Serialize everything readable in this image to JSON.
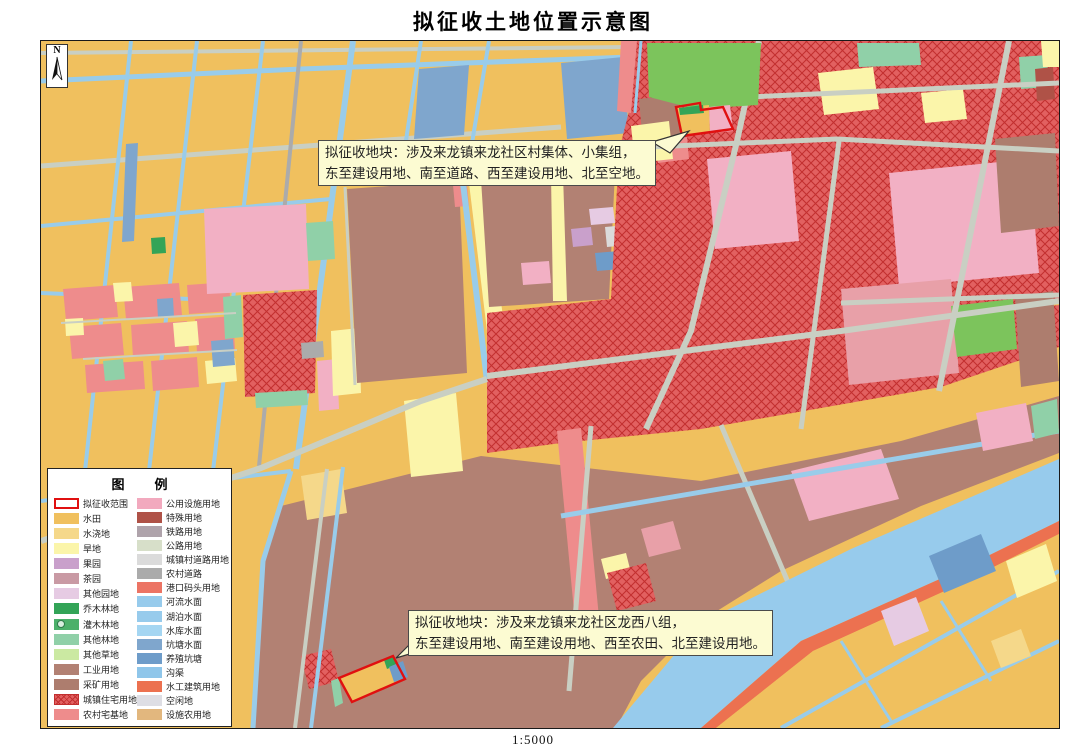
{
  "title": "拟征收土地位置示意图",
  "scale": "1:5000",
  "north_label": "N",
  "legend": {
    "title_left": "图",
    "title_right": "例",
    "columns": [
      {
        "items": [
          {
            "label": "拟征收范围",
            "color": "#FFFFFF",
            "type": "outline"
          },
          {
            "label": "水田",
            "color": "#F0C05E"
          },
          {
            "label": "水浇地",
            "color": "#F5D88A"
          },
          {
            "label": "旱地",
            "color": "#FBF5AA"
          },
          {
            "label": "果园",
            "color": "#C9A0CB"
          },
          {
            "label": "茶园",
            "color": "#C99AA4"
          },
          {
            "label": "其他园地",
            "color": "#E6CBE3"
          },
          {
            "label": "乔木林地",
            "color": "#33A457"
          },
          {
            "label": "灌木林地",
            "color": "#4CB06A",
            "type": "circle"
          },
          {
            "label": "其他林地",
            "color": "#90D0A8"
          },
          {
            "label": "其他草地",
            "color": "#CBE9A2"
          },
          {
            "label": "工业用地",
            "color": "#B28173"
          },
          {
            "label": "采矿用地",
            "color": "#AD7D6E"
          },
          {
            "label": "城镇住宅用地",
            "color": "#E26060",
            "type": "crosshatch"
          },
          {
            "label": "农村宅基地",
            "color": "#EE8C8C"
          }
        ]
      },
      {
        "items": [
          {
            "label": "公用设施用地",
            "color": "#F2A9BE"
          },
          {
            "label": "特殊用地",
            "color": "#AF5247"
          },
          {
            "label": "铁路用地",
            "color": "#AFA3AB"
          },
          {
            "label": "公路用地",
            "color": "#D7DFC9"
          },
          {
            "label": "城镇村道路用地",
            "color": "#DBDBDB"
          },
          {
            "label": "农村道路",
            "color": "#ABABAB"
          },
          {
            "label": "港口码头用地",
            "color": "#EC7464"
          },
          {
            "label": "河流水面",
            "color": "#97CBEC"
          },
          {
            "label": "湖泊水面",
            "color": "#97CBEC"
          },
          {
            "label": "水库水面",
            "color": "#A5D6F2"
          },
          {
            "label": "坑塘水面",
            "color": "#7FA6CD"
          },
          {
            "label": "养殖坑塘",
            "color": "#6E9CC9"
          },
          {
            "label": "沟渠",
            "color": "#8FC6EA"
          },
          {
            "label": "水工建筑用地",
            "color": "#EC7150"
          },
          {
            "label": "空闲地",
            "color": "#DEDEE4"
          },
          {
            "label": "设施农用地",
            "color": "#E2B77E"
          }
        ]
      }
    ]
  },
  "annotations": [
    {
      "line1": "拟征收地块：涉及来龙镇来龙社区村集体、小集组，",
      "line2": "东至建设用地、南至道路、西至建设用地、北至空地。"
    },
    {
      "line1": "拟征收地块：涉及来龙镇来龙社区龙西八组，",
      "line2": "东至建设用地、南至建设用地、西至农田、北至建设用地。"
    }
  ],
  "colors": {
    "paddy": "#F0C05E",
    "irrigated": "#F5D88A",
    "dry": "#FBF5AA",
    "orchard": "#C9A0CB",
    "other_garden": "#E6CBE3",
    "arbor": "#33A457",
    "other_forest": "#90D0A8",
    "industrial": "#B28173",
    "mining": "#AD7D6E",
    "urban_res": "#E26060",
    "urban_res_line": "#C22F2F",
    "rural_home": "#EE8C8C",
    "pink_big": "#F2B0C4",
    "salmon_pink": "#E8A0A8",
    "green_patch": "#7CC45C",
    "special": "#AF5247",
    "town_road": "#DBDBDB",
    "rural_road": "#ABABAB",
    "pond": "#7FA6CD",
    "aqua": "#6E9CC9",
    "river": "#97CBEC",
    "hydraulic": "#EC7150",
    "canal": "#99CCEA",
    "road": "#C9CFC3",
    "parcel_outline": "#E01010",
    "leader_fill": "#FCFBD2",
    "annotation_bg": "#FCFBD2",
    "annotation_border": "#4A4A4A",
    "map_border": "#1A1A1A"
  }
}
